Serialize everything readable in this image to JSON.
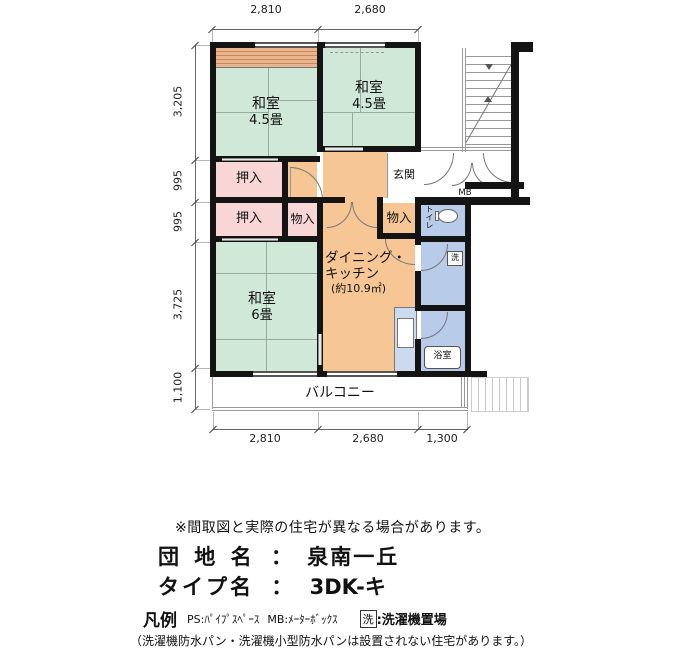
{
  "plan": {
    "dims": {
      "top": [
        "2,810",
        "2,680"
      ],
      "left": [
        "3,205",
        "995",
        "995",
        "3,725",
        "1,100"
      ],
      "bottom": [
        "2,810",
        "2,680",
        "1,300"
      ]
    },
    "rooms": {
      "washitsu1": {
        "name": "和室",
        "size": "4.5畳"
      },
      "washitsu2": {
        "name": "和室",
        "size": "4.5畳"
      },
      "washitsu3": {
        "name": "和室",
        "size": "6畳"
      },
      "dk": {
        "line1": "ダイニング・",
        "line2": "キッチン",
        "line3": "(約10.9㎡)"
      },
      "oshiire1": "押入",
      "oshiire2": "押入",
      "monoire1": "物入",
      "monoire2": "物入",
      "genkan": "玄関",
      "toilet": "トイレ",
      "bath": "浴室",
      "laundry": "洗",
      "mb": "MB",
      "balcony": "バルコニー"
    },
    "colors": {
      "tatami": "#cfe8d8",
      "kitchen": "#f6c795",
      "closet": "#f8d6d6",
      "wet": "#b8cbe8",
      "counter": "#ccdaf0",
      "white": "#ffffff"
    }
  },
  "footer": {
    "disclaimer": "※間取図と実際の住宅が異なる場合があります。",
    "estate_label": "団 地 名",
    "estate_sep": "：",
    "estate_value": "泉南一丘",
    "type_label": "タイプ名",
    "type_sep": "：",
    "type_value": "3DK-キ",
    "legend_title": "凡例",
    "legend_ps": "PS:ﾊﾟｲﾌﾟｽﾍﾟｰｽ",
    "legend_mb": "MB:ﾒｰﾀｰﾎﾞｯｸｽ",
    "legend_laundry_key": "洗",
    "legend_laundry_value": ":洗濯機置場",
    "legend_note": "（洗濯機防水パン・洗濯機小型防水パンは設置されない住宅があります。）"
  }
}
